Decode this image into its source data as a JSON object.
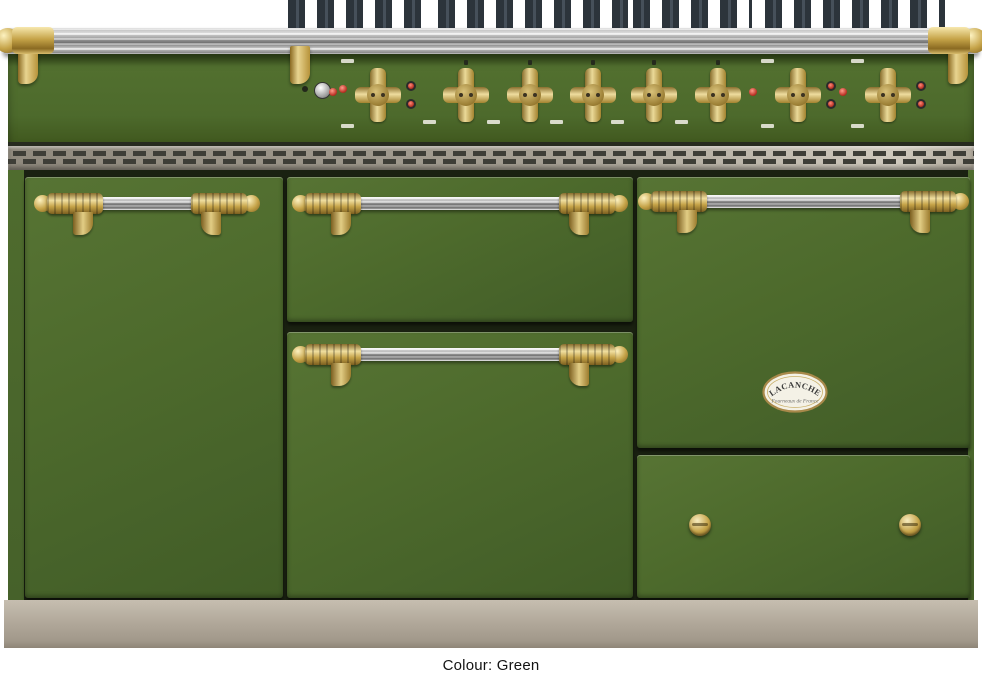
{
  "image": {
    "subject": "Lacanche range cooker in green enamel with brass trim",
    "caption": "Colour: Green"
  },
  "badge": {
    "brand": "LACANCHE",
    "tagline": "Fourneaux de France"
  },
  "panel": {
    "knob_count": 8,
    "oven_thermostat_knobs": 3,
    "burner_knobs": 5,
    "ignition_button": 1
  },
  "colors": {
    "body_green": "#4d692c",
    "body_green_dark": "#3f581f",
    "brass_trim": "#c5a348",
    "stainless_rail": "#c7c7c7",
    "grate_iron": "#2e373f",
    "vent_metal": "#a49e92",
    "plinth_taupe": "#b2a99b",
    "indicator_red": "#c0392b",
    "background": "#ffffff",
    "caption_text": "#141414"
  }
}
